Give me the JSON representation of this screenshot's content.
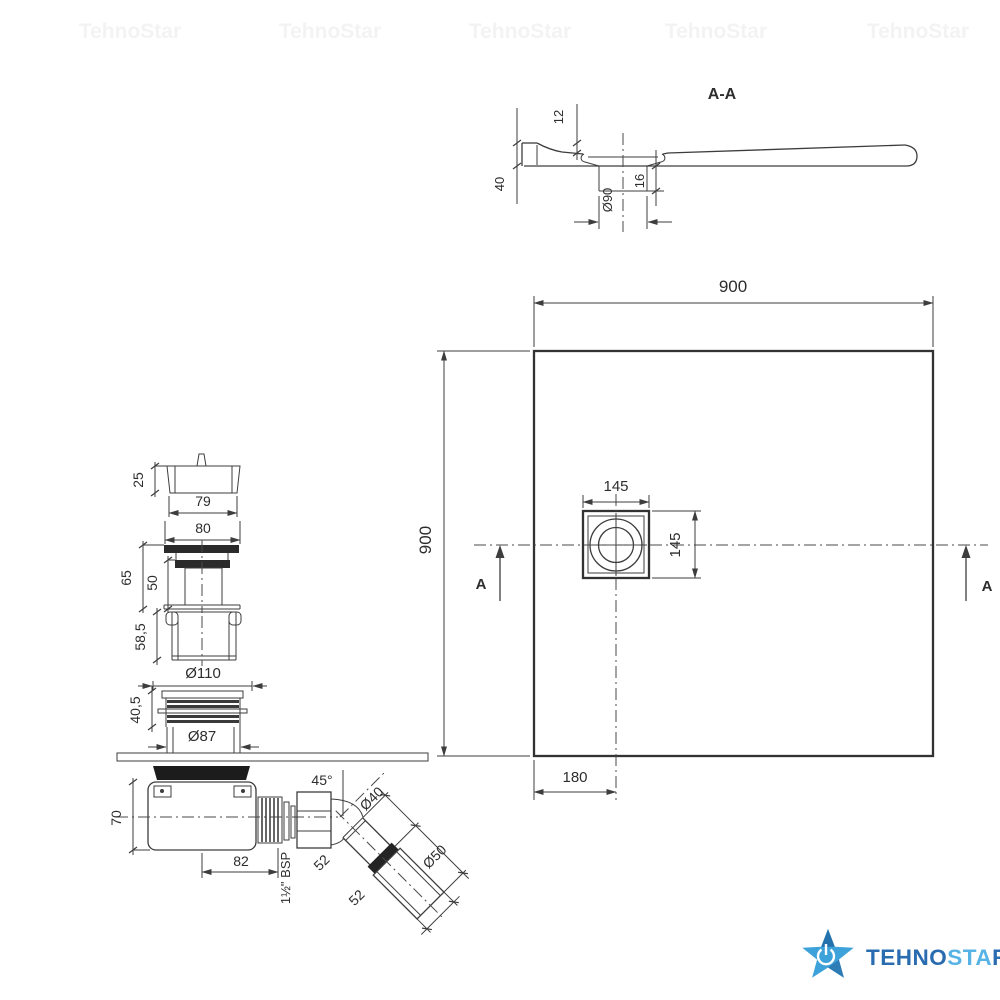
{
  "watermark": {
    "text": "TehnoStar"
  },
  "section_view": {
    "title": "A-A",
    "dim_rim_depth": "12",
    "dim_edge_height": "40",
    "dim_drain_hole": "Ø90",
    "dim_boss_height": "16"
  },
  "plan_view": {
    "dim_width": "900",
    "dim_height": "900",
    "dim_drain_width": "145",
    "dim_drain_height": "145",
    "dim_drain_offset": "180",
    "section_marker_left": "A",
    "section_marker_right": "A"
  },
  "assembly": {
    "cap_height": "25",
    "cap_width": "79",
    "flange_width": "80",
    "waste_total_height": "65",
    "waste_body_height": "50",
    "sleeve_height": "58,5",
    "flange_diameter": "Ø110",
    "ribbed_height": "40,5",
    "body_diameter": "Ø87",
    "trap_height": "70",
    "trap_length": "82",
    "thread_label": "1½\" BSP",
    "elbow_angle": "45°",
    "outlet_diameter": "Ø40",
    "socket_diameter": "Ø50",
    "segment_a": "52",
    "segment_b": "52"
  },
  "logo": {
    "word_part1": "TEHNO",
    "word_part2": "STA",
    "word_part3": "R",
    "color_dark": "#2a6cb0",
    "color_light": "#57b3e5",
    "star_light": "#3ea2da",
    "star_dark": "#2371ad"
  }
}
